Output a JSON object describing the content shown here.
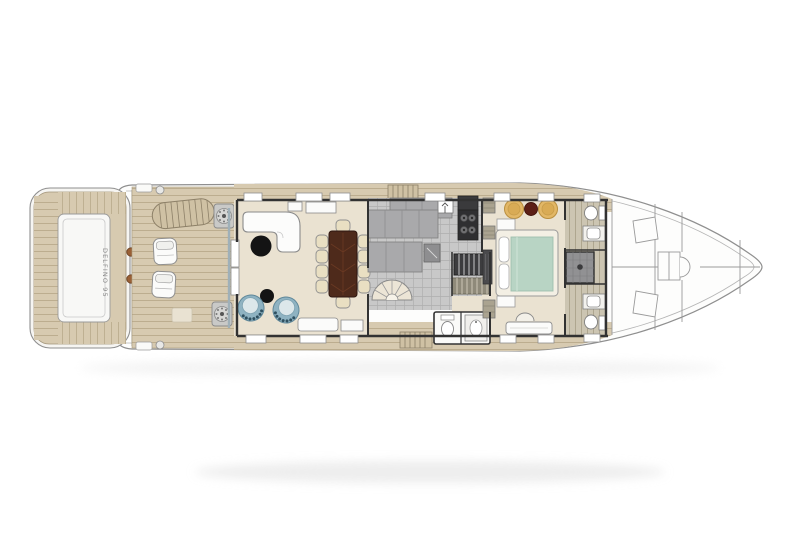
{
  "yacht_name": "DELFINO 95",
  "plan": {
    "type": "yacht-main-deck-floor-plan",
    "orientation": "bow-right",
    "rendering": "top-down architectural plan, colored amidships, line-art bow"
  },
  "colors": {
    "background": "#ffffff",
    "hull_fill": "#fdfdfc",
    "hull_line": "#8f8f8f",
    "teak": "#d7cab0",
    "teak_line": "#bcad8f",
    "cabin_floor": "#eae2d1",
    "galley_tile": "#c8c8c8",
    "counter": "#a9a9ab",
    "wall": "#323232",
    "glass_track": "#9fb0b8",
    "sofa": "#fcfcfb",
    "coffee_table": "#141414",
    "armchair": "#8fb3c2",
    "dining_table": "#4e2a1b",
    "dining_chair": "#e9dfc2",
    "bed_frame": "#f3efe4",
    "bed_spread": "#b8d4c4",
    "ottoman": "#e2b766",
    "pouf": "#5c1f16",
    "stair_dark": "#3c3c3e",
    "shower": "#919193",
    "bath_floor": "#ccc5b2",
    "bollard": "#9a6036"
  },
  "areas": [
    {
      "id": "swim-platform"
    },
    {
      "id": "aft-deck"
    },
    {
      "id": "salon"
    },
    {
      "id": "dining-area"
    },
    {
      "id": "galley"
    },
    {
      "id": "staircase"
    },
    {
      "id": "day-head"
    },
    {
      "id": "master-cabin"
    },
    {
      "id": "his-and-hers-bathroom"
    },
    {
      "id": "side-decks"
    },
    {
      "id": "foredeck"
    }
  ]
}
